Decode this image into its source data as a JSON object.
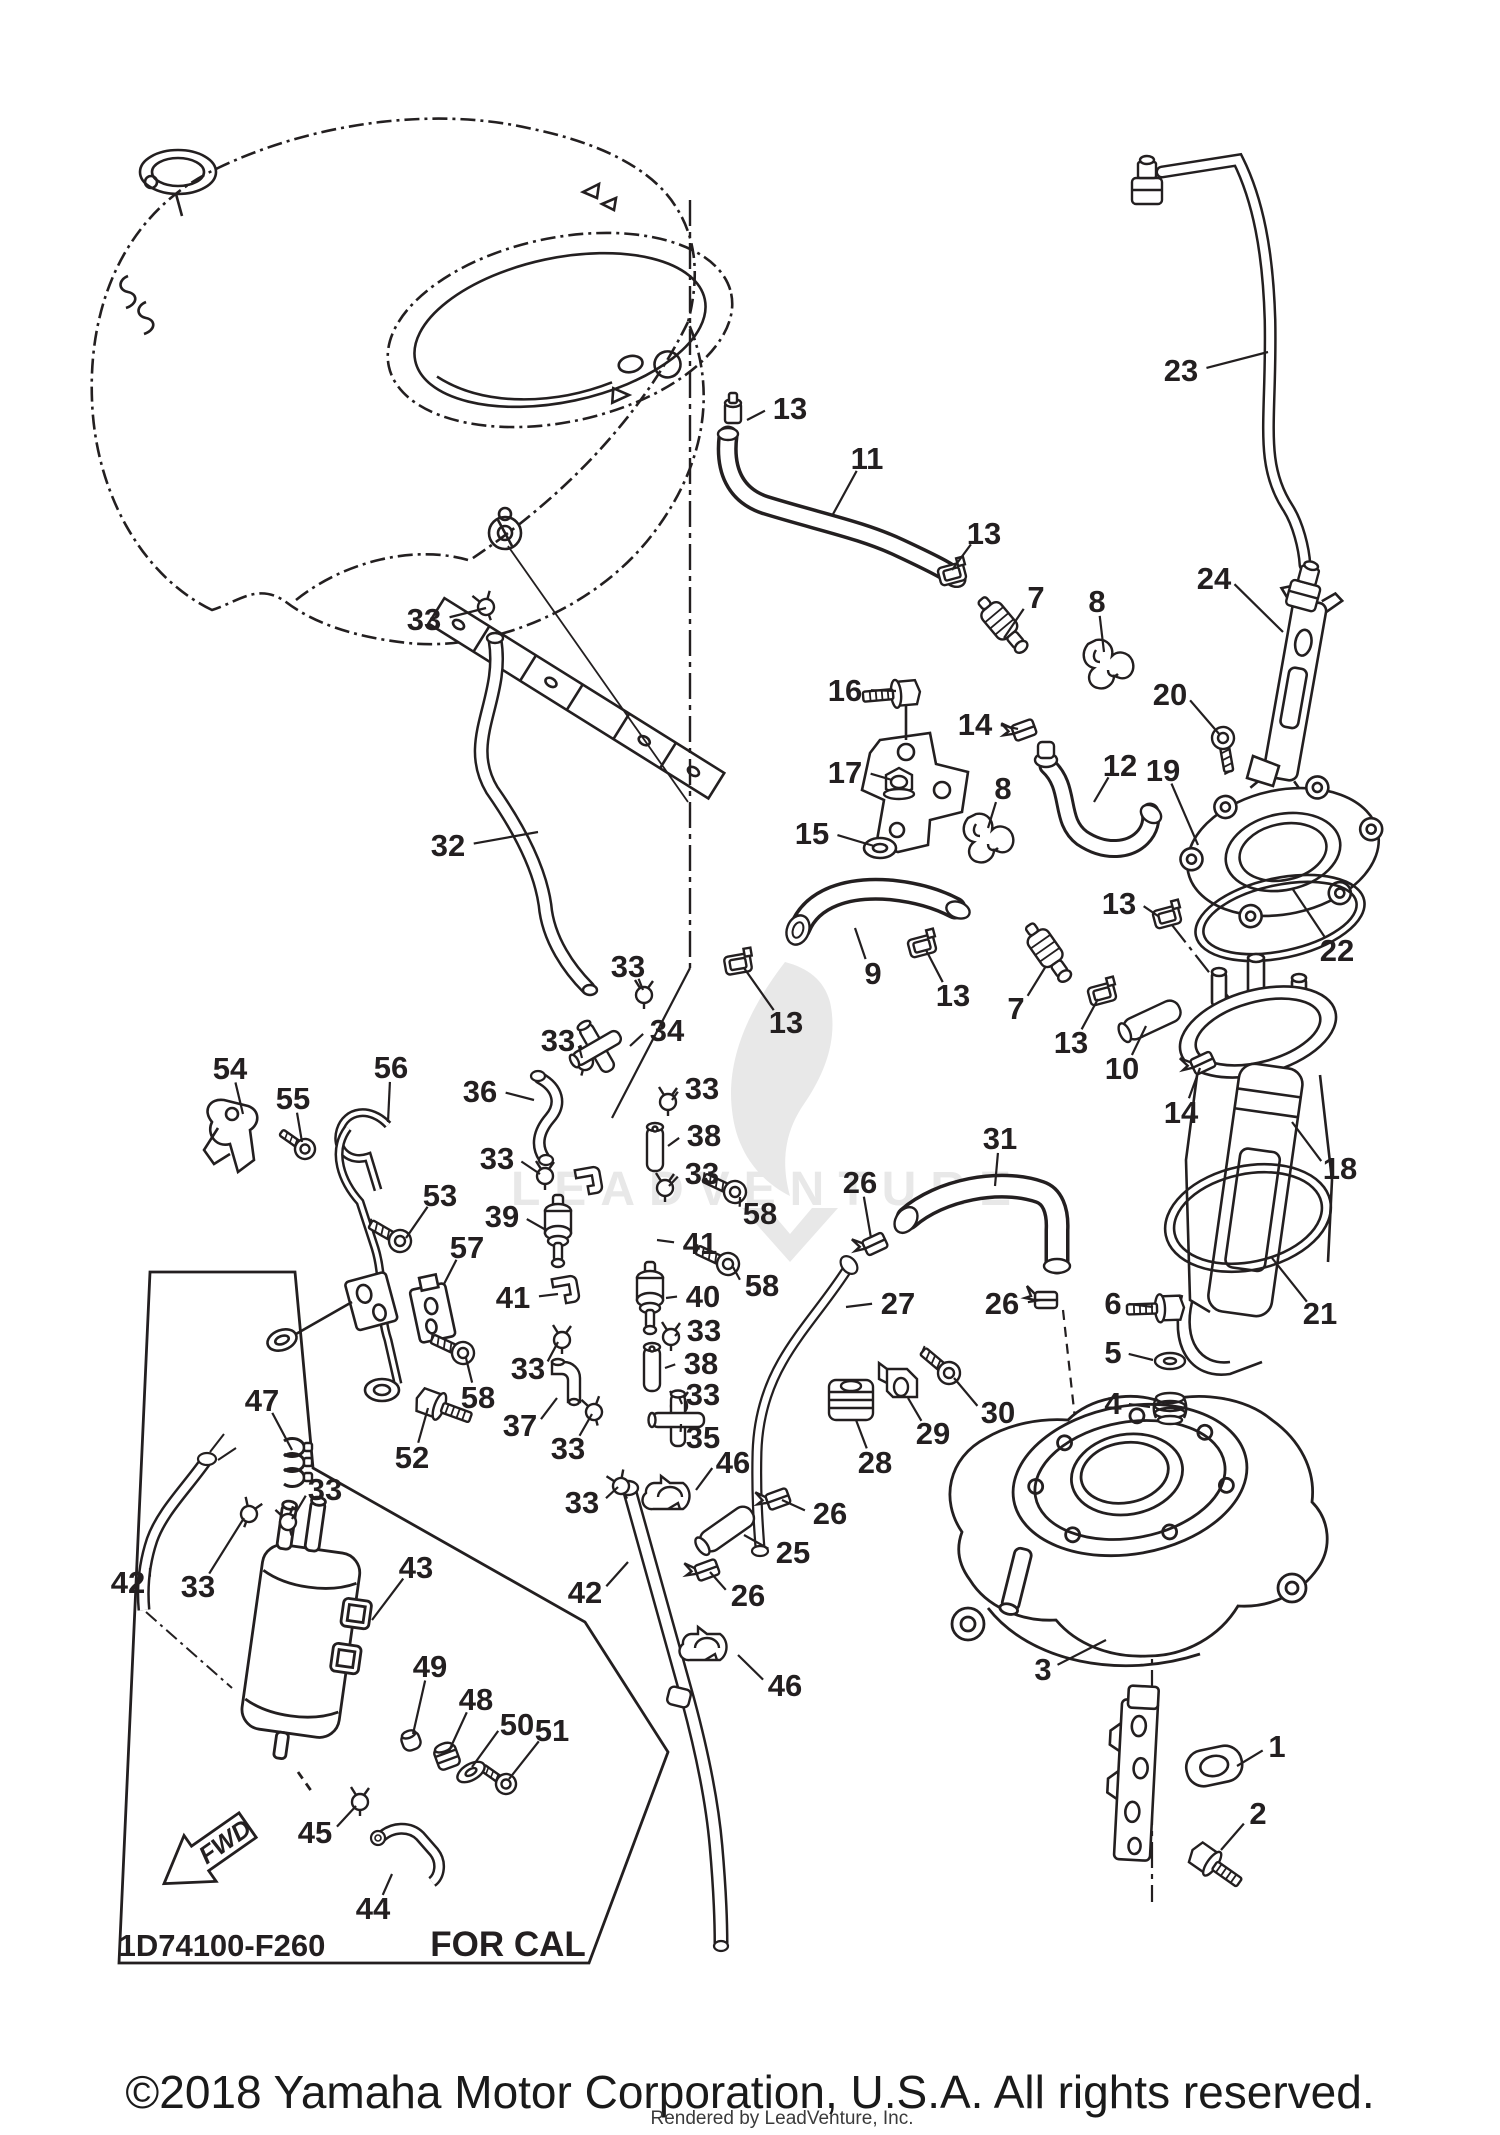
{
  "diagram": {
    "box_code": "1D74100-F260",
    "box_region_label": "FOR CAL",
    "fwd_label": "FWD",
    "watermark_text": "LEADVENTURE",
    "copyright": "©2018 Yamaha Motor Corporation, U.S.A. All rights reserved.",
    "rendered_by": "Rendered by LeadVenture, Inc.",
    "colors": {
      "line": "#231f20",
      "background": "#ffffff",
      "watermark": "#e8e8e8",
      "label": "#231f20"
    },
    "callouts": [
      {
        "part": "33",
        "x": 424,
        "y": 619,
        "tx": 486,
        "ty": 608
      },
      {
        "part": "32",
        "x": 448,
        "y": 845,
        "tx": 538,
        "ty": 832
      },
      {
        "part": "13",
        "x": 790,
        "y": 408,
        "tx": 747,
        "ty": 420
      },
      {
        "part": "11",
        "x": 867,
        "y": 458,
        "tx": 832,
        "ty": 516
      },
      {
        "part": "23",
        "x": 1181,
        "y": 370,
        "tx": 1268,
        "ty": 352
      },
      {
        "part": "24",
        "x": 1214,
        "y": 578,
        "tx": 1283,
        "ty": 632
      },
      {
        "part": "13",
        "x": 984,
        "y": 533,
        "tx": 952,
        "ty": 570
      },
      {
        "part": "7",
        "x": 1036,
        "y": 597,
        "tx": 1004,
        "ty": 638
      },
      {
        "part": "8",
        "x": 1097,
        "y": 601,
        "tx": 1104,
        "ty": 652
      },
      {
        "part": "16",
        "x": 845,
        "y": 690,
        "tx": 896,
        "ty": 691
      },
      {
        "part": "14",
        "x": 975,
        "y": 724,
        "tx": 1018,
        "ty": 729
      },
      {
        "part": "20",
        "x": 1170,
        "y": 694,
        "tx": 1220,
        "ty": 735
      },
      {
        "part": "17",
        "x": 845,
        "y": 772,
        "tx": 892,
        "ty": 780
      },
      {
        "part": "12",
        "x": 1120,
        "y": 765,
        "tx": 1094,
        "ty": 802
      },
      {
        "part": "19",
        "x": 1163,
        "y": 770,
        "tx": 1198,
        "ty": 845
      },
      {
        "part": "15",
        "x": 812,
        "y": 833,
        "tx": 874,
        "ty": 846
      },
      {
        "part": "8",
        "x": 1003,
        "y": 788,
        "tx": 988,
        "ty": 828
      },
      {
        "part": "22",
        "x": 1337,
        "y": 950,
        "tx": 1292,
        "ty": 888
      },
      {
        "part": "9",
        "x": 873,
        "y": 973,
        "tx": 855,
        "ty": 928
      },
      {
        "part": "13",
        "x": 786,
        "y": 1022,
        "tx": 744,
        "ty": 968
      },
      {
        "part": "13",
        "x": 953,
        "y": 995,
        "tx": 926,
        "ty": 950
      },
      {
        "part": "7",
        "x": 1016,
        "y": 1008,
        "tx": 1046,
        "ty": 966
      },
      {
        "part": "13",
        "x": 1071,
        "y": 1042,
        "tx": 1098,
        "ty": 999
      },
      {
        "part": "10",
        "x": 1122,
        "y": 1068,
        "tx": 1146,
        "ty": 1026
      },
      {
        "part": "14",
        "x": 1181,
        "y": 1112,
        "tx": 1200,
        "ty": 1068
      },
      {
        "part": "13",
        "x": 1119,
        "y": 903,
        "tx": 1158,
        "ty": 916
      },
      {
        "part": "18",
        "x": 1340,
        "y": 1168,
        "tx": 1292,
        "ty": 1122
      },
      {
        "part": "21",
        "x": 1320,
        "y": 1313,
        "tx": 1272,
        "ty": 1258
      },
      {
        "part": "31",
        "x": 1000,
        "y": 1138,
        "tx": 995,
        "ty": 1186
      },
      {
        "part": "26",
        "x": 860,
        "y": 1182,
        "tx": 871,
        "ty": 1238
      },
      {
        "part": "27",
        "x": 898,
        "y": 1303,
        "tx": 846,
        "ty": 1307
      },
      {
        "part": "26",
        "x": 1002,
        "y": 1303,
        "tx": 1040,
        "ty": 1300
      },
      {
        "part": "6",
        "x": 1113,
        "y": 1303,
        "tx": 1153,
        "ty": 1307
      },
      {
        "part": "5",
        "x": 1113,
        "y": 1352,
        "tx": 1153,
        "ty": 1360
      },
      {
        "part": "4",
        "x": 1113,
        "y": 1403,
        "tx": 1150,
        "ty": 1407
      },
      {
        "part": "30",
        "x": 998,
        "y": 1412,
        "tx": 954,
        "ty": 1378
      },
      {
        "part": "29",
        "x": 933,
        "y": 1433,
        "tx": 908,
        "ty": 1398
      },
      {
        "part": "28",
        "x": 875,
        "y": 1462,
        "tx": 856,
        "ty": 1420
      },
      {
        "part": "46",
        "x": 733,
        "y": 1462,
        "tx": 696,
        "ty": 1490
      },
      {
        "part": "26",
        "x": 830,
        "y": 1513,
        "tx": 782,
        "ty": 1500
      },
      {
        "part": "25",
        "x": 793,
        "y": 1552,
        "tx": 744,
        "ty": 1535
      },
      {
        "part": "26",
        "x": 748,
        "y": 1595,
        "tx": 710,
        "ty": 1572
      },
      {
        "part": "46",
        "x": 785,
        "y": 1685,
        "tx": 738,
        "ty": 1655
      },
      {
        "part": "42",
        "x": 585,
        "y": 1592,
        "tx": 628,
        "ty": 1562
      },
      {
        "part": "3",
        "x": 1043,
        "y": 1669,
        "tx": 1106,
        "ty": 1640
      },
      {
        "part": "1",
        "x": 1277,
        "y": 1746,
        "tx": 1237,
        "ty": 1766
      },
      {
        "part": "2",
        "x": 1258,
        "y": 1813,
        "tx": 1221,
        "ty": 1850
      },
      {
        "part": "54",
        "x": 230,
        "y": 1068,
        "tx": 243,
        "ty": 1114
      },
      {
        "part": "55",
        "x": 293,
        "y": 1098,
        "tx": 302,
        "ty": 1142
      },
      {
        "part": "56",
        "x": 391,
        "y": 1067,
        "tx": 388,
        "ty": 1122
      },
      {
        "part": "36",
        "x": 480,
        "y": 1091,
        "tx": 534,
        "ty": 1100
      },
      {
        "part": "33",
        "x": 628,
        "y": 966,
        "tx": 643,
        "ty": 990
      },
      {
        "part": "34",
        "x": 667,
        "y": 1030,
        "tx": 630,
        "ty": 1046
      },
      {
        "part": "33",
        "x": 558,
        "y": 1040,
        "tx": 582,
        "ty": 1058
      },
      {
        "part": "33",
        "x": 702,
        "y": 1088,
        "tx": 672,
        "ty": 1100
      },
      {
        "part": "38",
        "x": 704,
        "y": 1135,
        "tx": 668,
        "ty": 1146
      },
      {
        "part": "33",
        "x": 702,
        "y": 1173,
        "tx": 669,
        "ty": 1186
      },
      {
        "part": "58",
        "x": 760,
        "y": 1213,
        "tx": 740,
        "ty": 1197
      },
      {
        "part": "41",
        "x": 700,
        "y": 1243,
        "tx": 657,
        "ty": 1240
      },
      {
        "part": "33",
        "x": 497,
        "y": 1158,
        "tx": 540,
        "ty": 1174
      },
      {
        "part": "39",
        "x": 502,
        "y": 1216,
        "tx": 546,
        "ty": 1230
      },
      {
        "part": "58",
        "x": 762,
        "y": 1285,
        "tx": 733,
        "ty": 1267
      },
      {
        "part": "40",
        "x": 703,
        "y": 1296,
        "tx": 666,
        "ty": 1298
      },
      {
        "part": "41",
        "x": 513,
        "y": 1297,
        "tx": 558,
        "ty": 1294
      },
      {
        "part": "33",
        "x": 704,
        "y": 1330,
        "tx": 675,
        "ty": 1336
      },
      {
        "part": "38",
        "x": 701,
        "y": 1363,
        "tx": 665,
        "ty": 1368
      },
      {
        "part": "33",
        "x": 703,
        "y": 1394,
        "tx": 682,
        "ty": 1404
      },
      {
        "part": "35",
        "x": 703,
        "y": 1437,
        "tx": 681,
        "ty": 1424
      },
      {
        "part": "33",
        "x": 528,
        "y": 1368,
        "tx": 558,
        "ty": 1342
      },
      {
        "part": "37",
        "x": 520,
        "y": 1425,
        "tx": 557,
        "ty": 1398
      },
      {
        "part": "33",
        "x": 568,
        "y": 1448,
        "tx": 592,
        "ty": 1414
      },
      {
        "part": "33",
        "x": 582,
        "y": 1502,
        "tx": 618,
        "ty": 1487
      },
      {
        "part": "53",
        "x": 440,
        "y": 1195,
        "tx": 406,
        "ty": 1238
      },
      {
        "part": "57",
        "x": 467,
        "y": 1247,
        "tx": 444,
        "ty": 1284
      },
      {
        "part": "58",
        "x": 478,
        "y": 1397,
        "tx": 466,
        "ty": 1358
      },
      {
        "part": "52",
        "x": 412,
        "y": 1457,
        "tx": 428,
        "ty": 1408
      },
      {
        "part": "47",
        "x": 262,
        "y": 1400,
        "tx": 292,
        "ty": 1450
      },
      {
        "part": "42",
        "x": 128,
        "y": 1582,
        "tx": 150,
        "ty": 1568
      },
      {
        "part": "33",
        "x": 325,
        "y": 1489,
        "tx": 292,
        "ty": 1519
      },
      {
        "part": "33",
        "x": 198,
        "y": 1586,
        "tx": 244,
        "ty": 1518
      },
      {
        "part": "43",
        "x": 416,
        "y": 1567,
        "tx": 372,
        "ty": 1620
      },
      {
        "part": "49",
        "x": 430,
        "y": 1666,
        "tx": 413,
        "ty": 1734
      },
      {
        "part": "48",
        "x": 476,
        "y": 1699,
        "tx": 449,
        "ty": 1751
      },
      {
        "part": "50",
        "x": 517,
        "y": 1724,
        "tx": 472,
        "ty": 1767
      },
      {
        "part": "51",
        "x": 552,
        "y": 1730,
        "tx": 509,
        "ty": 1779
      },
      {
        "part": "45",
        "x": 315,
        "y": 1832,
        "tx": 356,
        "ty": 1806
      },
      {
        "part": "44",
        "x": 373,
        "y": 1908,
        "tx": 392,
        "ty": 1874
      }
    ],
    "parts": [
      {
        "type": "clamp",
        "x": 486,
        "y": 607,
        "r": -20
      },
      {
        "type": "clamp",
        "x": 644,
        "y": 995,
        "r": 0
      },
      {
        "type": "clamp",
        "x": 585,
        "y": 1062,
        "r": 15
      },
      {
        "type": "clamp",
        "x": 668,
        "y": 1102,
        "r": 0
      },
      {
        "type": "clamp",
        "x": 665,
        "y": 1188,
        "r": 0
      },
      {
        "type": "clamp",
        "x": 545,
        "y": 1176,
        "r": 0
      },
      {
        "type": "clamp",
        "x": 562,
        "y": 1340,
        "r": 0
      },
      {
        "type": "clamp",
        "x": 594,
        "y": 1412,
        "r": -15
      },
      {
        "type": "clamp",
        "x": 621,
        "y": 1486,
        "r": -25
      },
      {
        "type": "clamp",
        "x": 671,
        "y": 1337,
        "r": 0
      },
      {
        "type": "clamp",
        "x": 679,
        "y": 1406,
        "r": 0
      },
      {
        "type": "clamp",
        "x": 288,
        "y": 1522,
        "r": -15
      },
      {
        "type": "clamp",
        "x": 249,
        "y": 1514,
        "r": 20
      },
      {
        "type": "clamp",
        "x": 360,
        "y": 1802,
        "r": 0
      },
      {
        "type": "hoseclamp",
        "x": 952,
        "y": 574,
        "r": -15
      },
      {
        "type": "hoseclamp",
        "x": 738,
        "y": 964,
        "r": -10
      },
      {
        "type": "hoseclamp",
        "x": 922,
        "y": 946,
        "r": -15
      },
      {
        "type": "hoseclamp",
        "x": 1102,
        "y": 994,
        "r": -15
      },
      {
        "type": "hoseclamp",
        "x": 1167,
        "y": 917,
        "r": -15
      },
      {
        "type": "capnipple",
        "x": 733,
        "y": 413,
        "r": 0
      },
      {
        "type": "bandclamp",
        "x": 1024,
        "y": 730,
        "r": -20
      },
      {
        "type": "bandclamp",
        "x": 1203,
        "y": 1063,
        "r": -25
      },
      {
        "type": "bandclamp",
        "x": 875,
        "y": 1244,
        "r": -25
      },
      {
        "type": "bandclamp",
        "x": 1046,
        "y": 1300,
        "r": 0
      },
      {
        "type": "bandclamp",
        "x": 778,
        "y": 1499,
        "r": -20
      },
      {
        "type": "bandclamp",
        "x": 707,
        "y": 1570,
        "r": -20
      },
      {
        "type": "screw",
        "x": 735,
        "y": 1192,
        "r": -155
      },
      {
        "type": "screw",
        "x": 728,
        "y": 1264,
        "r": -155
      },
      {
        "type": "screw",
        "x": 463,
        "y": 1353,
        "r": -155
      },
      {
        "type": "screw",
        "x": 400,
        "y": 1241,
        "r": -150
      },
      {
        "type": "screw",
        "x": 949,
        "y": 1373,
        "r": -140
      },
      {
        "type": "screw",
        "x": 1223,
        "y": 738,
        "r": 80
      },
      {
        "type": "screwS",
        "x": 506,
        "y": 1784,
        "r": -145
      },
      {
        "type": "screwS",
        "x": 305,
        "y": 1149,
        "r": -145
      },
      {
        "type": "bolt",
        "x": 906,
        "y": 693,
        "r": 85
      },
      {
        "type": "bolt",
        "x": 1170,
        "y": 1308,
        "r": 88
      },
      {
        "type": "bolt",
        "x": 1204,
        "y": 1858,
        "r": -55
      },
      {
        "type": "bolt",
        "x": 430,
        "y": 1403,
        "r": -70
      },
      {
        "type": "nut",
        "x": 899,
        "y": 782,
        "r": 0
      },
      {
        "type": "washer",
        "x": 1170,
        "y": 1361,
        "r": 0
      },
      {
        "type": "grommet",
        "x": 1170,
        "y": 1408,
        "r": 0
      },
      {
        "type": "tube",
        "x": 1152,
        "y": 1020,
        "r": -25
      },
      {
        "type": "tube",
        "x": 727,
        "y": 1529,
        "r": -35
      },
      {
        "type": "smalltube",
        "x": 655,
        "y": 1149,
        "r": 0
      },
      {
        "type": "smalltube",
        "x": 652,
        "y": 1369,
        "r": 0
      },
      {
        "type": "valve",
        "x": 558,
        "y": 1233,
        "r": 0
      },
      {
        "type": "valve",
        "x": 650,
        "y": 1300,
        "r": 0
      },
      {
        "type": "injector",
        "x": 1007,
        "y": 630,
        "r": -40
      },
      {
        "type": "injector",
        "x": 1052,
        "y": 958,
        "r": -35
      },
      {
        "type": "holder8",
        "x": 1106,
        "y": 664,
        "r": 0
      },
      {
        "type": "holder8",
        "x": 986,
        "y": 838,
        "r": 0
      },
      {
        "type": "clip41",
        "x": 589,
        "y": 1182,
        "r": -10
      },
      {
        "type": "clip41",
        "x": 566,
        "y": 1291,
        "r": -10
      },
      {
        "type": "holder46",
        "x": 672,
        "y": 1497,
        "r": 0
      },
      {
        "type": "holder46",
        "x": 709,
        "y": 1648,
        "r": 0
      },
      {
        "type": "damper",
        "x": 851,
        "y": 1400,
        "r": 0
      },
      {
        "type": "bracket29",
        "x": 903,
        "y": 1387,
        "r": 0
      },
      {
        "type": "tfit",
        "x": 597,
        "y": 1048,
        "r": -30
      },
      {
        "type": "tfit",
        "x": 678,
        "y": 1420,
        "r": 0
      },
      {
        "type": "elbow",
        "x": 566,
        "y": 1386,
        "r": 0
      },
      {
        "type": "clipstack",
        "x": 296,
        "y": 1462,
        "r": 0
      },
      {
        "type": "bushing",
        "x": 411,
        "y": 1741,
        "r": -20
      },
      {
        "type": "seal",
        "x": 447,
        "y": 1757,
        "r": -20
      },
      {
        "type": "washer",
        "x": 471,
        "y": 1772,
        "r": -30
      },
      {
        "type": "conn",
        "x": 1147,
        "y": 180,
        "r": 0
      },
      {
        "type": "conn",
        "x": 1306,
        "y": 585,
        "r": 15
      }
    ]
  }
}
